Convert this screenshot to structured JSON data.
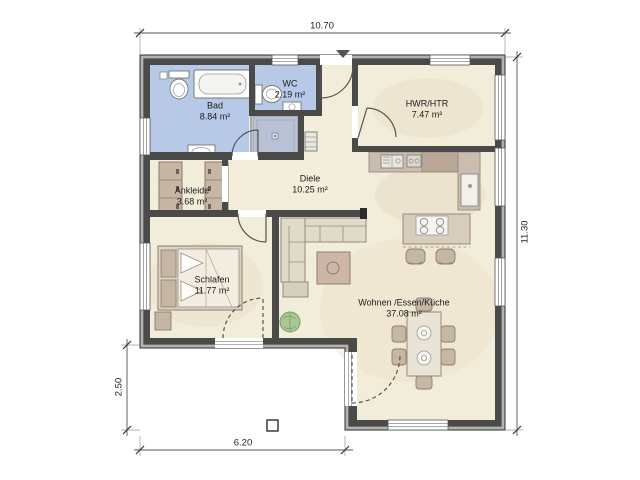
{
  "plan": {
    "type": "architectural-floor-plan",
    "rooms": [
      {
        "id": "bad",
        "label": "Bad",
        "area": "8.84 m²"
      },
      {
        "id": "wc",
        "label": "WC",
        "area": "2.19 m²"
      },
      {
        "id": "hwr_htr",
        "label": "HWR/HTR",
        "area": "7.47 m²"
      },
      {
        "id": "ankleide",
        "label": "Ankleide",
        "area": "3.68 m²"
      },
      {
        "id": "diele",
        "label": "Diele",
        "area": "10.25 m²"
      },
      {
        "id": "schlafen",
        "label": "Schlafen",
        "area": "11.77 m²"
      },
      {
        "id": "wohnen",
        "label": "Wohnen /Essen/Küche",
        "area": "37.08 m²"
      }
    ],
    "dimensions_m": {
      "top_width": "10.70",
      "right_height": "11.30",
      "left_terrace_depth": "2.50",
      "bottom_terrace_width": "6.20"
    },
    "fixtures": [
      "bathtub",
      "toilet",
      "washbasin",
      "shower",
      "radiator",
      "wardrobe",
      "double-bed",
      "dresser",
      "corner-sofa",
      "coffee-table",
      "potted-plant",
      "kitchen-counter",
      "kitchen-sink",
      "tall-appliance",
      "kitchen-island",
      "cooktop",
      "bar-stool",
      "dining-table",
      "dining-chair",
      "terrace-column",
      "entrance-marker"
    ],
    "colors": {
      "wet_room_fill": "#b7c9e6",
      "shower_fill": "#b8c2d4",
      "floor_fill": "#f2ecda",
      "wall_dark": "#4a4a48",
      "wall_outer_band": "#b2b2ae",
      "furniture_tan": "#c7b6a4",
      "counter_brown": "#bfae9f",
      "sofa_fill": "#e0dacb",
      "plant_green": "#a9c795"
    }
  }
}
